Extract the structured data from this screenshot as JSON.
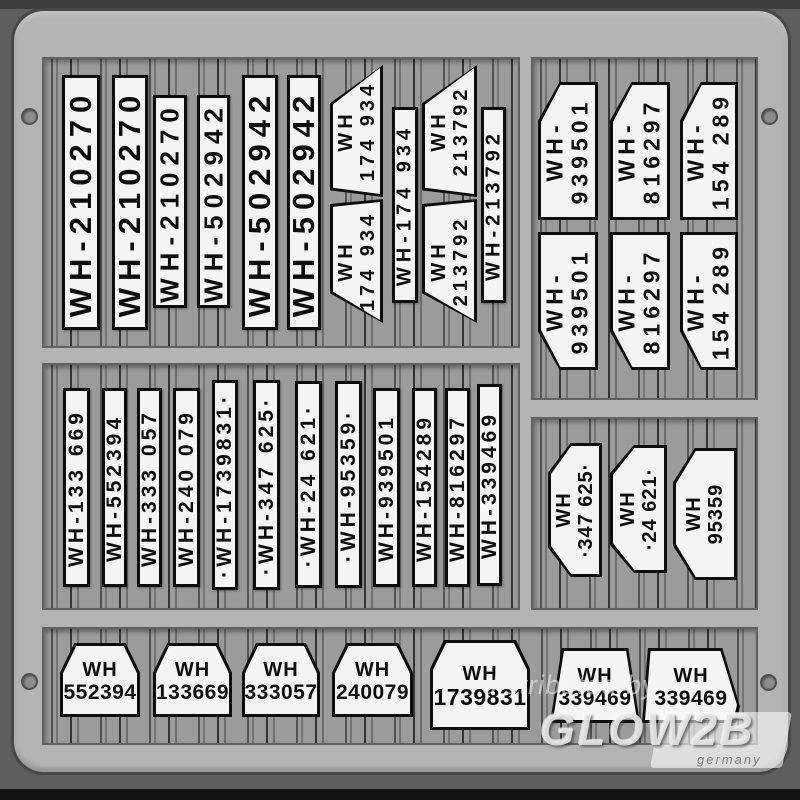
{
  "watermark": {
    "distributed_by": "distributed by",
    "brand": "GLOW2B",
    "brand_sub": "germany"
  },
  "colors": {
    "background": "#5e5e5e",
    "sheet": "#b4b4b4",
    "section_bg": "#9b9b9b",
    "plate_bg": "#f4f4f4",
    "plate_border": "#0d0d0d"
  },
  "sections": {
    "top_left": {
      "plates": [
        {
          "text": "WH-210270"
        },
        {
          "text": "WH-210270"
        },
        {
          "text": "WH-210270"
        },
        {
          "text": "WH-502942"
        },
        {
          "text": "WH-502942"
        },
        {
          "text": "WH-502942"
        },
        {
          "line1": "WH",
          "line2": "174 934"
        },
        {
          "line1": "WH",
          "line2": "174 934"
        },
        {
          "text": "WH-174 934"
        },
        {
          "line1": "WH",
          "line2": "213792"
        },
        {
          "line1": "WH",
          "line2": "213792"
        },
        {
          "text": "WH-213792"
        }
      ]
    },
    "top_right": {
      "plates": [
        {
          "line1": "WH-",
          "line2": "939501"
        },
        {
          "line1": "WH-",
          "line2": "816297"
        },
        {
          "line1": "WH-",
          "line2": "154 289"
        },
        {
          "line1": "WH-",
          "line2": "939501"
        },
        {
          "line1": "WH-",
          "line2": "816297"
        },
        {
          "line1": "WH-",
          "line2": "154 289"
        }
      ]
    },
    "middle_left": {
      "plates": [
        {
          "text": "WH-133 669"
        },
        {
          "text": "WH-552394"
        },
        {
          "text": "WH-333 057"
        },
        {
          "text": "WH-240 079"
        },
        {
          "text": "·WH-1739831·"
        },
        {
          "text": "·WH-347 625·"
        },
        {
          "text": "·WH-24 621·"
        },
        {
          "text": "·WH-95359·"
        },
        {
          "text": "WH-939501"
        },
        {
          "text": "WH-154289"
        },
        {
          "text": "WH-816297"
        },
        {
          "text": "WH-339469"
        }
      ]
    },
    "middle_right": {
      "plates": [
        {
          "line1": "WH",
          "line2": "·347 625·"
        },
        {
          "line1": "WH",
          "line2": "·24 621·"
        },
        {
          "line1": "WH",
          "line2": "95359"
        }
      ]
    },
    "bottom": {
      "plates": [
        {
          "line1": "WH",
          "line2": "552394"
        },
        {
          "line1": "WH",
          "line2": "133669"
        },
        {
          "line1": "WH",
          "line2": "333057"
        },
        {
          "line1": "WH",
          "line2": "240079"
        },
        {
          "line1": "WH",
          "line2": "1739831"
        },
        {
          "line1": "WH",
          "line2": "339469"
        },
        {
          "line1": "WH",
          "line2": "339469"
        }
      ]
    }
  }
}
